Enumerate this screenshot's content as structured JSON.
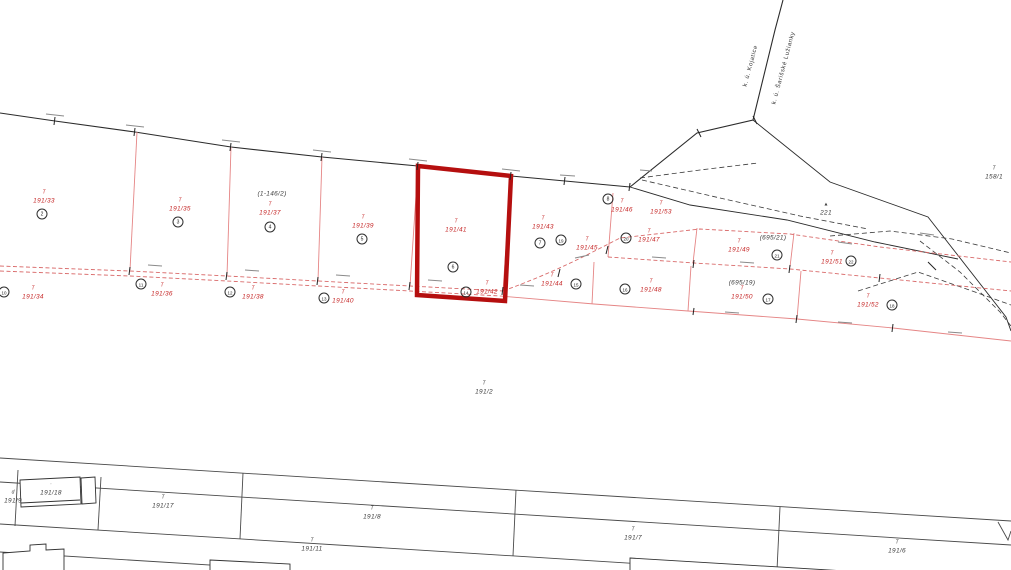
{
  "map": {
    "type": "cadastral-map",
    "highlight": {
      "parcel": "191/41",
      "color": "#b50f0f"
    },
    "colors": {
      "red_label": "#c62828",
      "red_line": "#e58585",
      "red_dash": "#d96a6a",
      "black_line": "#2b2b2b",
      "gray_line": "#4a4a4a",
      "background": "#ffffff"
    },
    "boundary_labels": [
      {
        "text": "k. ú. Kojatice",
        "x": 751,
        "y": 66
      },
      {
        "text": "k. ú. Šarišské Lužianky",
        "x": 784,
        "y": 68
      }
    ],
    "parcel_labels": [
      {
        "text": "191/33",
        "color": "red",
        "sym": "T",
        "x": 44,
        "y": 201
      },
      {
        "text": "191/35",
        "color": "red",
        "sym": "T",
        "x": 180,
        "y": 209
      },
      {
        "text": "191/37",
        "color": "red",
        "sym": "T",
        "x": 270,
        "y": 213
      },
      {
        "text": "191/39",
        "color": "red",
        "sym": "T",
        "x": 363,
        "y": 226
      },
      {
        "text": "191/41",
        "color": "red",
        "sym": "T",
        "x": 456,
        "y": 230
      },
      {
        "text": "191/43",
        "color": "red",
        "sym": "T",
        "x": 543,
        "y": 227
      },
      {
        "text": "191/45",
        "color": "red",
        "sym": "T",
        "x": 587,
        "y": 248
      },
      {
        "text": "191/46",
        "color": "red",
        "sym": "T",
        "x": 622,
        "y": 210
      },
      {
        "text": "191/53",
        "color": "red",
        "sym": "T",
        "x": 661,
        "y": 212
      },
      {
        "text": "191/47",
        "color": "red",
        "sym": "T",
        "x": 649,
        "y": 240
      },
      {
        "text": "191/49",
        "color": "red",
        "sym": "T",
        "x": 739,
        "y": 250
      },
      {
        "text": "191/51",
        "color": "red",
        "sym": "T",
        "x": 832,
        "y": 262
      },
      {
        "text": "191/34",
        "color": "red",
        "sym": "T",
        "x": 33,
        "y": 297
      },
      {
        "text": "191/36",
        "color": "red",
        "sym": "T",
        "x": 162,
        "y": 294
      },
      {
        "text": "191/38",
        "color": "red",
        "sym": "T",
        "x": 253,
        "y": 297
      },
      {
        "text": "191/40",
        "color": "red",
        "sym": "T",
        "x": 343,
        "y": 301
      },
      {
        "text": "191/42",
        "color": "red",
        "sym": "T",
        "x": 487,
        "y": 292
      },
      {
        "text": "191/44",
        "color": "red",
        "sym": "T",
        "x": 552,
        "y": 284
      },
      {
        "text": "191/48",
        "color": "red",
        "sym": "T",
        "x": 651,
        "y": 290
      },
      {
        "text": "191/50",
        "color": "red",
        "sym": "T",
        "x": 742,
        "y": 297
      },
      {
        "text": "191/52",
        "color": "red",
        "sym": "T",
        "x": 868,
        "y": 305
      },
      {
        "text": "(1-146/2)",
        "color": "blk",
        "sym": "",
        "x": 272,
        "y": 194
      },
      {
        "text": "(695/21)",
        "color": "blk",
        "sym": "",
        "x": 773,
        "y": 238
      },
      {
        "text": "(695/19)",
        "color": "blk",
        "sym": "",
        "x": 742,
        "y": 283
      },
      {
        "text": "221",
        "color": "blk",
        "sym": "▲",
        "x": 826,
        "y": 213
      },
      {
        "text": "158/1",
        "color": "blk",
        "sym": "T",
        "x": 994,
        "y": 177
      },
      {
        "text": "191/2",
        "color": "blk",
        "sym": "T",
        "x": 484,
        "y": 392
      },
      {
        "text": "191/9",
        "color": "blk",
        "sym": "d",
        "x": 13,
        "y": 501
      },
      {
        "text": "191/18",
        "color": "blk",
        "sym": "·",
        "x": 51,
        "y": 493
      },
      {
        "text": "191/17",
        "color": "blk",
        "sym": "T",
        "x": 163,
        "y": 506
      },
      {
        "text": "191/8",
        "color": "blk",
        "sym": "T",
        "x": 372,
        "y": 517
      },
      {
        "text": "191/11",
        "color": "blk",
        "sym": "T",
        "x": 312,
        "y": 549
      },
      {
        "text": "191/7",
        "color": "blk",
        "sym": "T",
        "x": 633,
        "y": 538
      },
      {
        "text": "191/6",
        "color": "blk",
        "sym": "T",
        "x": 897,
        "y": 551
      }
    ],
    "parcel_number_circles": [
      {
        "n": "2",
        "x": 42,
        "y": 214
      },
      {
        "n": "3",
        "x": 178,
        "y": 222
      },
      {
        "n": "4",
        "x": 270,
        "y": 227
      },
      {
        "n": "5",
        "x": 362,
        "y": 239
      },
      {
        "n": "6",
        "x": 453,
        "y": 267
      },
      {
        "n": "7",
        "x": 540,
        "y": 243
      },
      {
        "n": "8",
        "x": 608,
        "y": 199
      },
      {
        "n": "19",
        "x": 561,
        "y": 240
      },
      {
        "n": "20",
        "x": 626,
        "y": 238
      },
      {
        "n": "21",
        "x": 777,
        "y": 255
      },
      {
        "n": "22",
        "x": 851,
        "y": 261
      },
      {
        "n": "10",
        "x": 4,
        "y": 292
      },
      {
        "n": "11",
        "x": 141,
        "y": 284
      },
      {
        "n": "12",
        "x": 230,
        "y": 292
      },
      {
        "n": "13",
        "x": 324,
        "y": 298
      },
      {
        "n": "14",
        "x": 466,
        "y": 292
      },
      {
        "n": "15",
        "x": 576,
        "y": 284
      },
      {
        "n": "16",
        "x": 625,
        "y": 289
      },
      {
        "n": "17",
        "x": 768,
        "y": 299
      },
      {
        "n": "18",
        "x": 892,
        "y": 305
      }
    ]
  }
}
